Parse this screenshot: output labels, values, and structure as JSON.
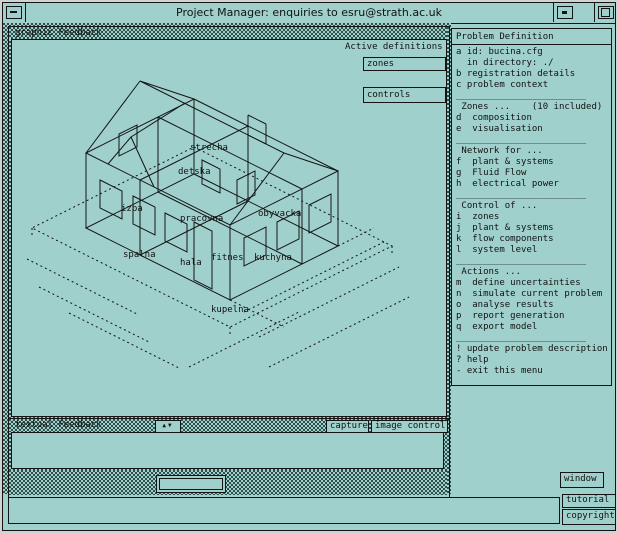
{
  "window": {
    "title": "Project Manager: enquiries to esru@strath.ac.uk"
  },
  "graphic_window": {
    "header": "graphic Feedback",
    "active_definitions_label": "Active definitions",
    "zones_box": "zones",
    "controls_box": "controls",
    "zone_labels": [
      {
        "text": "strecha"
      },
      {
        "text": "detska"
      },
      {
        "text": "izba"
      },
      {
        "text": "pracovna"
      },
      {
        "text": "obyvacka"
      },
      {
        "text": "spalna"
      },
      {
        "text": "hala"
      },
      {
        "text": "fitnes"
      },
      {
        "text": "kuchyna"
      },
      {
        "text": "kupelna"
      }
    ]
  },
  "menu": {
    "rows": [
      {
        "type": "header",
        "text": "Problem Definition"
      },
      {
        "type": "item",
        "text": "a id: bucina.cfg"
      },
      {
        "type": "item",
        "text": "  in directory: ./"
      },
      {
        "type": "item",
        "text": "b registration details"
      },
      {
        "type": "item",
        "text": "c problem context"
      },
      {
        "type": "separator",
        "text": "________________________"
      },
      {
        "type": "label",
        "text": " Zones ...    (10 included)"
      },
      {
        "type": "item",
        "text": "d  composition"
      },
      {
        "type": "item",
        "text": "e  visualisation"
      },
      {
        "type": "separator",
        "text": "________________________"
      },
      {
        "type": "label",
        "text": " Network for ..."
      },
      {
        "type": "item",
        "text": "f  plant & systems"
      },
      {
        "type": "item",
        "text": "g  Fluid Flow"
      },
      {
        "type": "item",
        "text": "h  electrical power"
      },
      {
        "type": "separator",
        "text": "________________________"
      },
      {
        "type": "label",
        "text": " Control of ..."
      },
      {
        "type": "item",
        "text": "i  zones"
      },
      {
        "type": "item",
        "text": "j  plant & systems"
      },
      {
        "type": "item",
        "text": "k  flow components"
      },
      {
        "type": "item",
        "text": "l  system level"
      },
      {
        "type": "separator",
        "text": "________________________"
      },
      {
        "type": "label",
        "text": " Actions ..."
      },
      {
        "type": "item",
        "text": "m  define uncertainties"
      },
      {
        "type": "item",
        "text": "n  simulate current problem"
      },
      {
        "type": "item",
        "text": "o  analyse results"
      },
      {
        "type": "item",
        "text": "p  report generation"
      },
      {
        "type": "item",
        "text": "q  export model"
      },
      {
        "type": "separator",
        "text": "________________________"
      },
      {
        "type": "item",
        "text": "! update problem description"
      },
      {
        "type": "item",
        "text": "? help"
      },
      {
        "type": "item",
        "text": "- exit this menu"
      }
    ]
  },
  "textual_window": {
    "header": "textual Feedback",
    "scroll_up_icon": "▲",
    "scroll_down_icon": "▼",
    "capture_button": "capture",
    "image_control_button": "image control"
  },
  "side_buttons": {
    "window": "window",
    "tutorial": "tutorial",
    "copyright": "copyright"
  },
  "colors": {
    "background_teal": "#9fd0cb",
    "line_black": "#141414"
  }
}
